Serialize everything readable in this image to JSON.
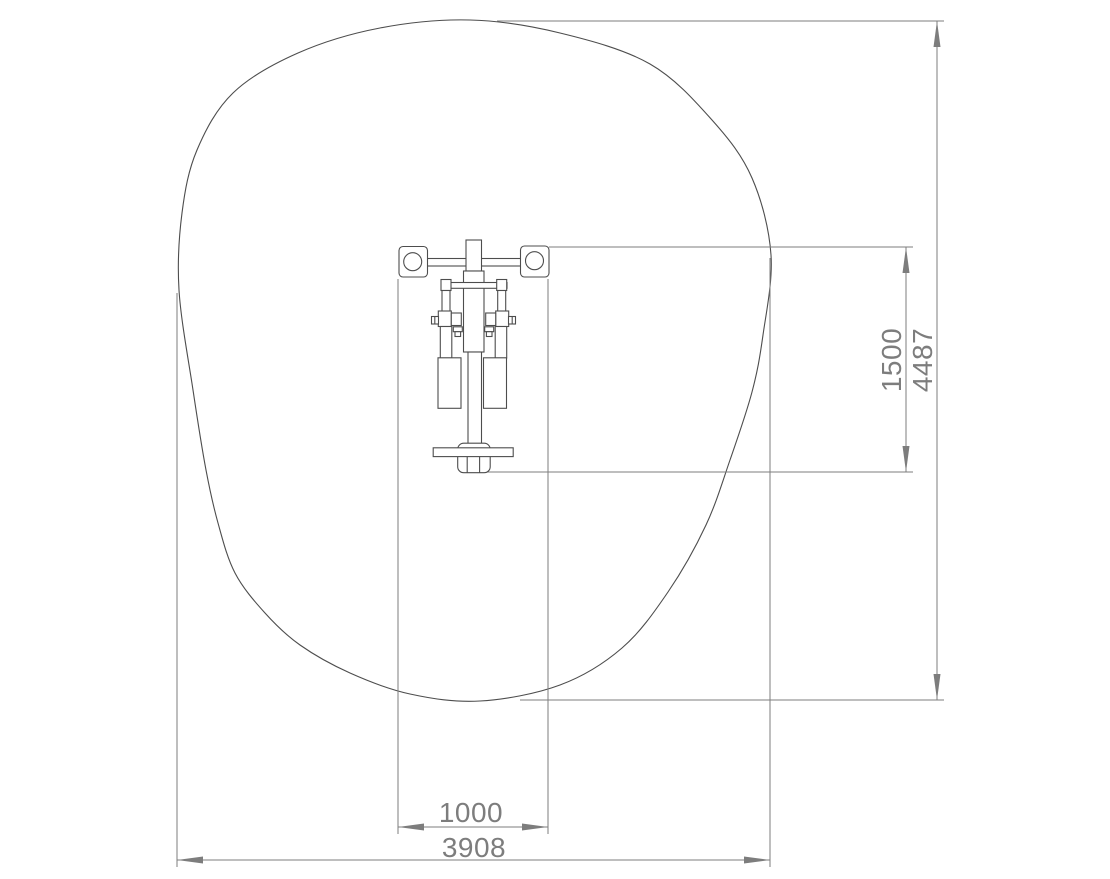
{
  "drawing": {
    "type": "equipment-plan-view-technical-drawing",
    "dimension_labels": {
      "machine_width": "1000",
      "machine_length": "1500",
      "area_width": "3908",
      "area_length": "4487"
    },
    "colors": {
      "background": "#ffffff",
      "object_outline": "#4d4d4d",
      "dimension_lines": "#7d7d7d",
      "dimension_text": "#7d7d7d"
    }
  }
}
